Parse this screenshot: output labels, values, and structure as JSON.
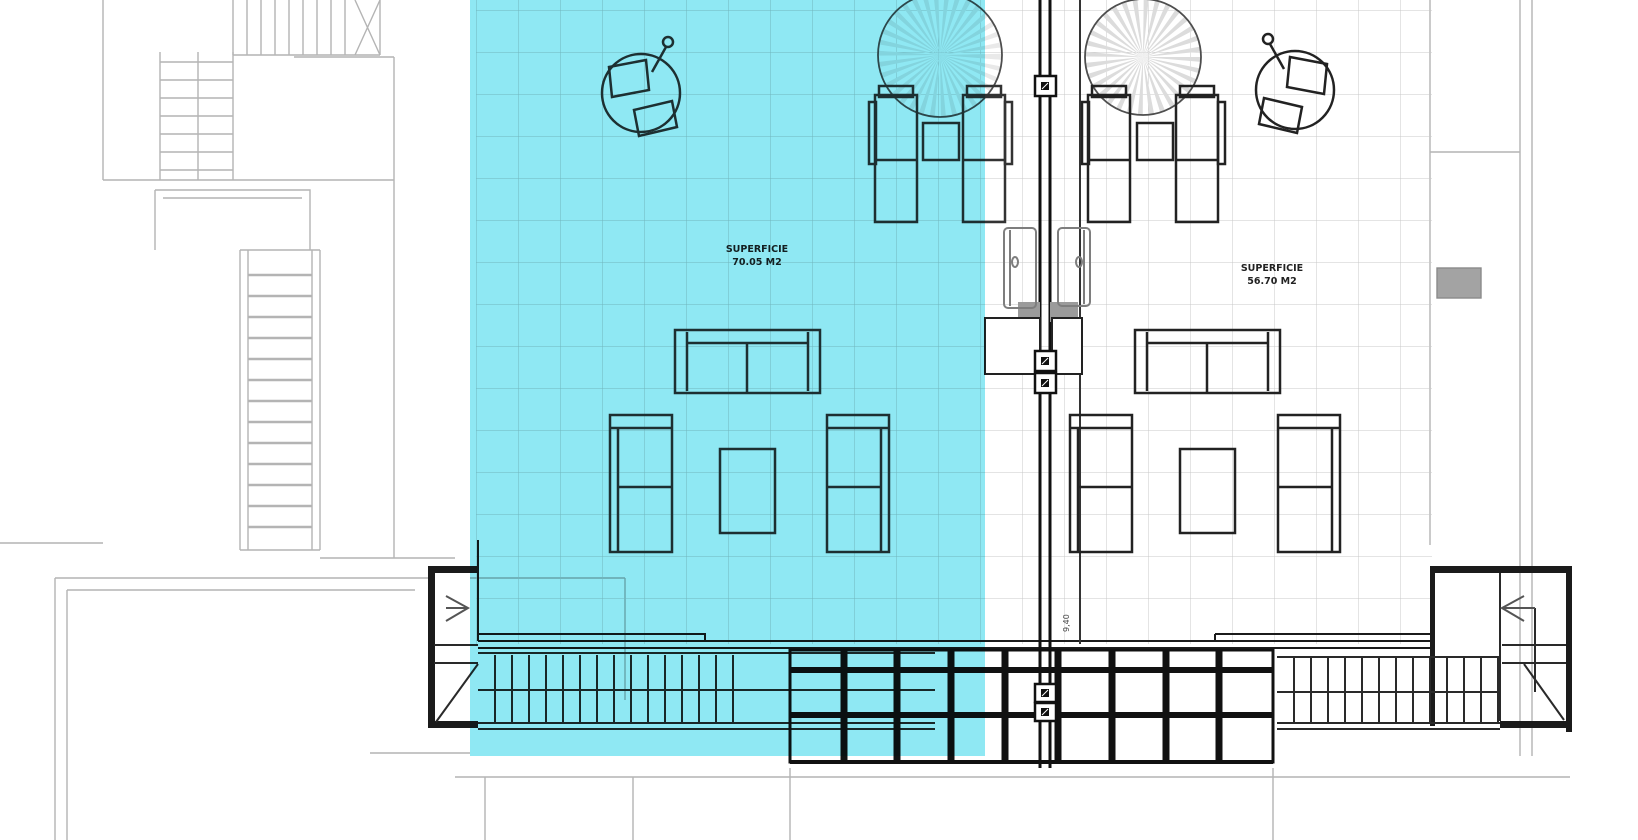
{
  "plan": {
    "type": "architectural-floor-plan-solarium",
    "unit_left": {
      "superficie_label": "SUPERFICIE",
      "area_label": "70.05 M2",
      "highlighted": true
    },
    "unit_right": {
      "superficie_label": "SUPERFICIE",
      "area_label": "56.70 M2",
      "highlighted": false
    },
    "dimension_label": "9,40",
    "colors": {
      "highlight": "#8fe8f3",
      "linework": "#1b1b1b",
      "furniture_left": "#333333",
      "furniture_right": "#222222",
      "neighbor_lines": "#b4b4b4",
      "tile_grid": "#c8c8c8",
      "door_gray": "#7e7e7e",
      "background": "#ffffff"
    },
    "elements": [
      "parasol-left",
      "parasol-right",
      "closed-parasol-left",
      "closed-parasol-right",
      "sun-loungers",
      "side-tables",
      "sofa-groups",
      "coffee-tables",
      "divider-wall",
      "pillar-markers",
      "doors",
      "planter-boxes",
      "stair-left",
      "stair-right",
      "pergola-grid",
      "neighbor-stairs"
    ]
  }
}
